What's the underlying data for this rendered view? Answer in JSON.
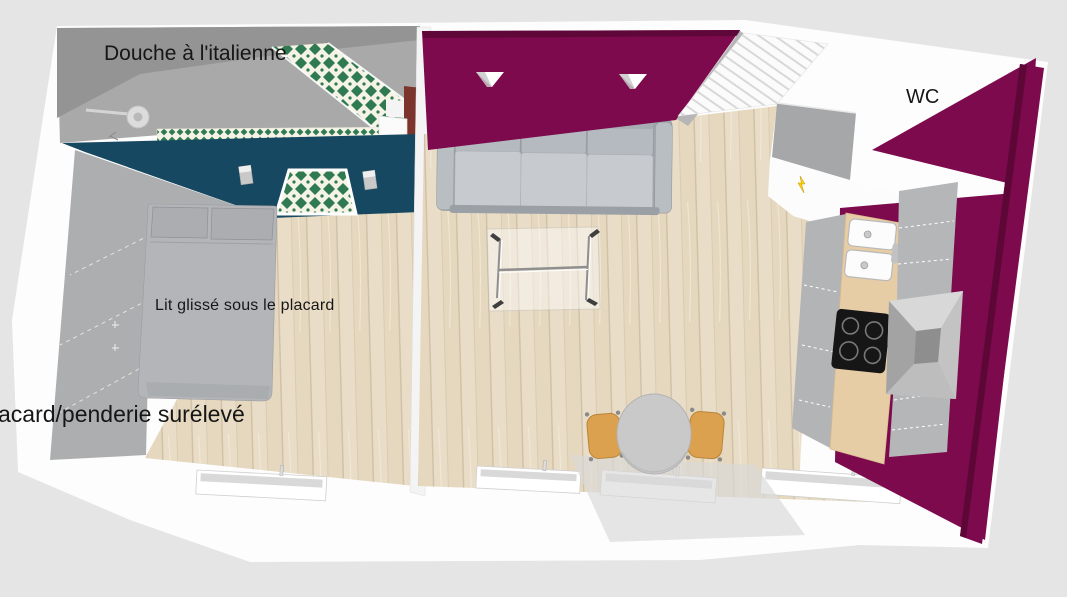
{
  "labels": {
    "shower": "Douche à l'italienne",
    "bed": "Lit glissé sous le placard",
    "closet": "acard/penderie surélevé",
    "wc": "WC"
  },
  "palette": {
    "background": "#e5e5e6",
    "accent-wall": "#7c0a4d",
    "accent-wall-dark": "#5c0736",
    "bathroom-wall-teal": "#174861",
    "tile-green": "#2f7a50",
    "floor-wood": "#e9ddc7",
    "counter-wood": "#e7cda6",
    "chair-wood": "#dca14e",
    "sofa-gray": "#c7cbd0",
    "bed-gray": "#b3b5b8",
    "cabinet-gray": "#b5b6b8",
    "marker-yellow": "#ffd400",
    "label-text": "#161616"
  }
}
